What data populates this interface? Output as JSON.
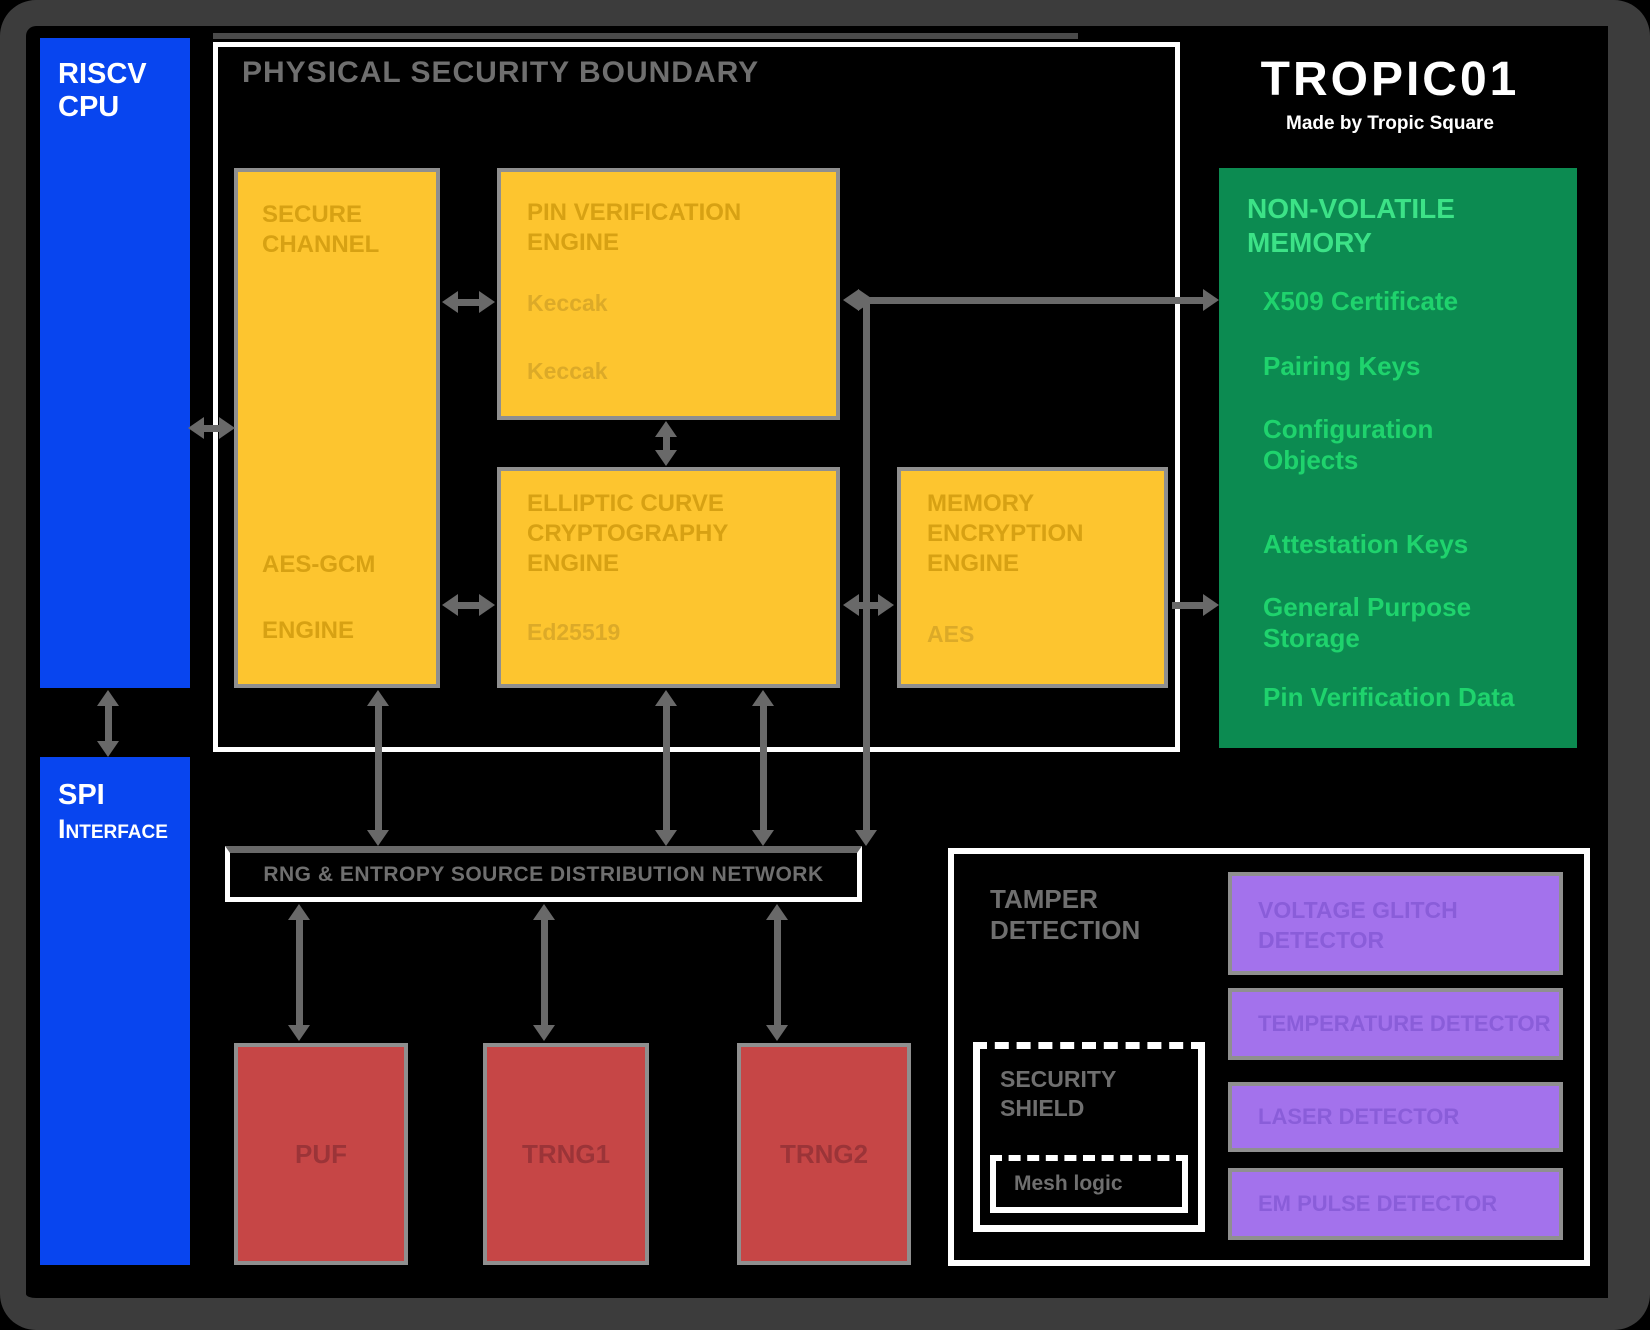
{
  "logo": {
    "title": "TROPIC01",
    "subtitle": "Made by Tropic Square"
  },
  "cpu_block": {
    "label": "RISCV\nCPU"
  },
  "spi_block": {
    "label_main": "SPI",
    "label_sub": "Interface"
  },
  "security_perimeter": {
    "title": "PHYSICAL SECURITY BOUNDARY"
  },
  "engines": {
    "secure_channel": {
      "title": "SECURE\nCHANNEL",
      "sub1": "AES-GCM",
      "sub2": "ENGINE"
    },
    "pin_verification": {
      "title": "PIN VERIFICATION\nENGINE",
      "items": [
        "Keccak",
        "Keccak"
      ]
    },
    "ecc": {
      "title": "ELLIPTIC CURVE\nCRYPTOGRAPHY\nENGINE",
      "items": [
        "Ed25519"
      ]
    },
    "memory_encryption": {
      "title": "MEMORY\nENCRYPTION\nENGINE",
      "items": [
        "AES"
      ]
    }
  },
  "nvm": {
    "title": "NON-VOLATILE\nMEMORY",
    "items": [
      "X509 Certificate",
      "Pairing Keys",
      "Configuration\nObjects",
      "Attestation Keys",
      "General Purpose\nStorage",
      "Pin Verification Data"
    ]
  },
  "entropy_bus": {
    "label": "RNG & ENTROPY SOURCE DISTRIBUTION NETWORK"
  },
  "entropy_sources": [
    {
      "label": "PUF"
    },
    {
      "label": "TRNG1"
    },
    {
      "label": "TRNG2"
    }
  ],
  "tamper": {
    "title": "TAMPER\nDETECTION",
    "sensors": [
      "VOLTAGE GLITCH\nDETECTOR",
      "TEMPERATURE DETECTOR",
      "LASER DETECTOR",
      "EM PULSE DETECTOR"
    ],
    "shield": {
      "title": "SECURITY\nSHIELD",
      "inner_label": "Mesh logic"
    }
  },
  "colors": {
    "blue": "#0845EF",
    "yellow": "#FDC52F",
    "red": "#C64646",
    "purple": "#A372EC",
    "green": "#0C8B51",
    "green_header_text": "#3CE287",
    "green_item_text": "#1FD36D",
    "arrow_gray": "#696969",
    "frame_gray": "#3C3C3C",
    "faint_yellow_text": "#D7A113",
    "faint_red_text": "#9B3438",
    "faint_purple_text": "#8A5DD9",
    "muted_gray_text": "#6F6F6F"
  }
}
